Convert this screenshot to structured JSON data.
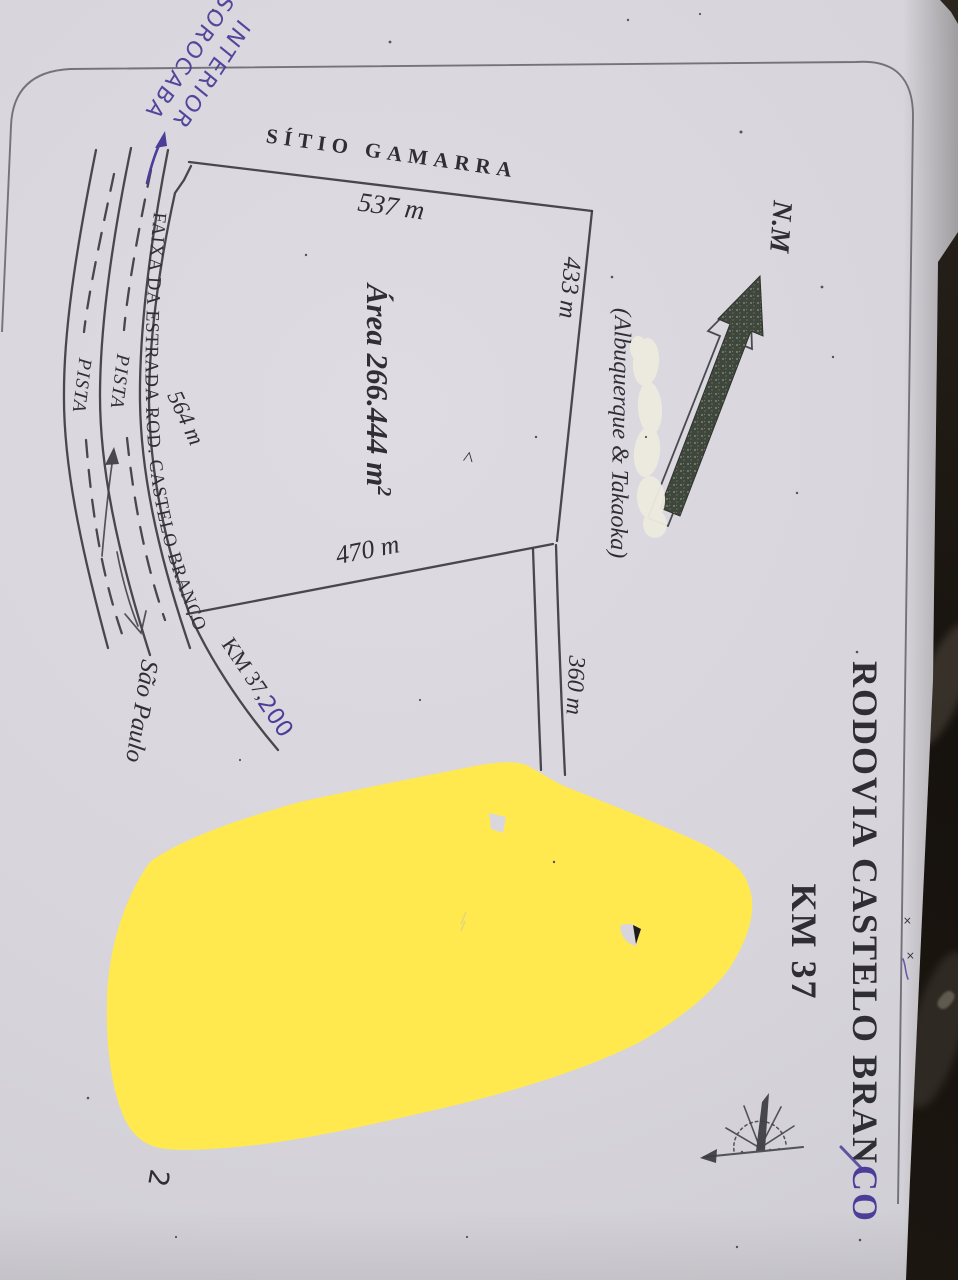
{
  "photo": {
    "paper_color": "#d7d5db",
    "background_color": "#16120d",
    "highlight_color": "#ffe94e",
    "ink_color": "#3b3b41",
    "pen_ink_color": "#4a3e99"
  },
  "title": {
    "line1_printed": "RODOVIA CASTELO BRAN",
    "line1_pen_traced": "CO",
    "line2": "KM 37"
  },
  "parcel": {
    "name": "SÍTIO GAMARRA",
    "area_text": "Área 266.444 m",
    "area_superscript": "2",
    "owners": "(Albuquerque & Takaoka)",
    "side_top": "537 m",
    "side_right": "433 m",
    "side_bottom": "470 m",
    "side_road": "564 m",
    "side_inner": "360 m",
    "check_mark": "<"
  },
  "road": {
    "strip_label": "FAIXA DA ESTRADA ROD. CASTELO BRANCO",
    "lane1_label": "PISTA",
    "lane2_label": "PISTA",
    "km_marker_printed": "KM 37,",
    "km_marker_pen": "200",
    "south_direction_label": "São Paulo"
  },
  "north": {
    "label": "N.M"
  },
  "handwriting": {
    "direction_line1": "INTERIOR",
    "direction_line2": "SOROCABA",
    "partial_covered_mark": "2"
  },
  "edge_marks": {
    "x1": "×",
    "x2": "×"
  }
}
